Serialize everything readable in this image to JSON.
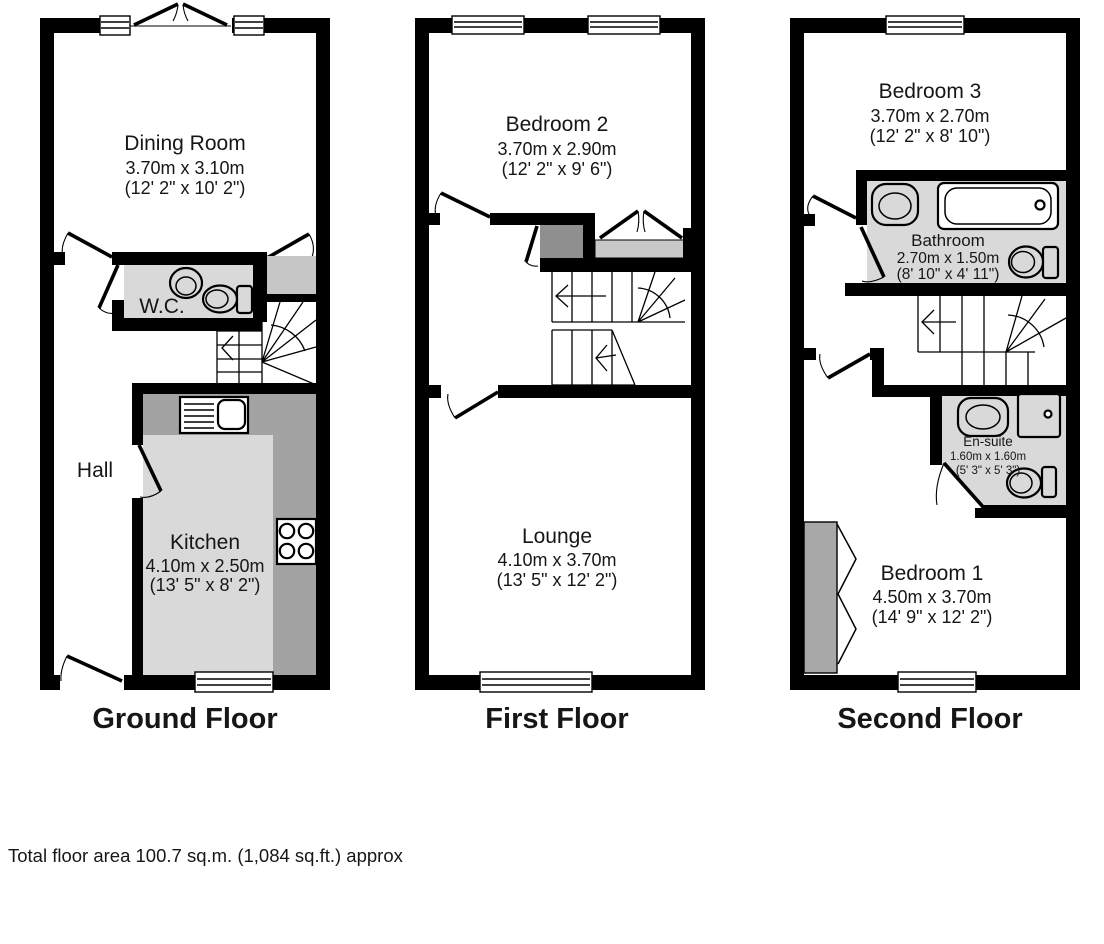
{
  "floors": {
    "ground": {
      "label": "Ground Floor",
      "dining": {
        "name": "Dining Room",
        "metric": "3.70m x 3.10m",
        "imperial": "(12' 2\" x 10' 2\")"
      },
      "wc": {
        "name": "W.C."
      },
      "hall": {
        "name": "Hall"
      },
      "kitchen": {
        "name": "Kitchen",
        "metric": "4.10m x 2.50m",
        "imperial": "(13' 5\" x 8' 2\")"
      }
    },
    "first": {
      "label": "First Floor",
      "bedroom2": {
        "name": "Bedroom 2",
        "metric": "3.70m x 2.90m",
        "imperial": "(12' 2\" x 9' 6\")"
      },
      "lounge": {
        "name": "Lounge",
        "metric": "4.10m x 3.70m",
        "imperial": "(13' 5\" x 12' 2\")"
      }
    },
    "second": {
      "label": "Second Floor",
      "bedroom3": {
        "name": "Bedroom 3",
        "metric": "3.70m x 2.70m",
        "imperial": "(12' 2\" x 8' 10\")"
      },
      "bathroom": {
        "name": "Bathroom",
        "metric": "2.70m x 1.50m",
        "imperial": "(8' 10\" x 4' 11\")"
      },
      "ensuite": {
        "name": "En-suite",
        "metric": "1.60m x 1.60m",
        "imperial": "(5' 3\" x 5' 3\")"
      },
      "bedroom1": {
        "name": "Bedroom 1",
        "metric": "4.50m x 3.70m",
        "imperial": "(14' 9\" x 12' 2\")"
      }
    }
  },
  "footer": "Total floor area 100.7 sq.m. (1,084 sq.ft.) approx",
  "colors": {
    "wall": "#000000",
    "wet_room": "#d9d9d9",
    "kitchen_counter": "#a3a3a3",
    "cupboard_dark": "#8f8f8f",
    "cupboard_light": "#c6c6c6",
    "balcony_sill": "#c8c8c8",
    "wardrobe": "#a8a8a8",
    "text": "#161616"
  }
}
